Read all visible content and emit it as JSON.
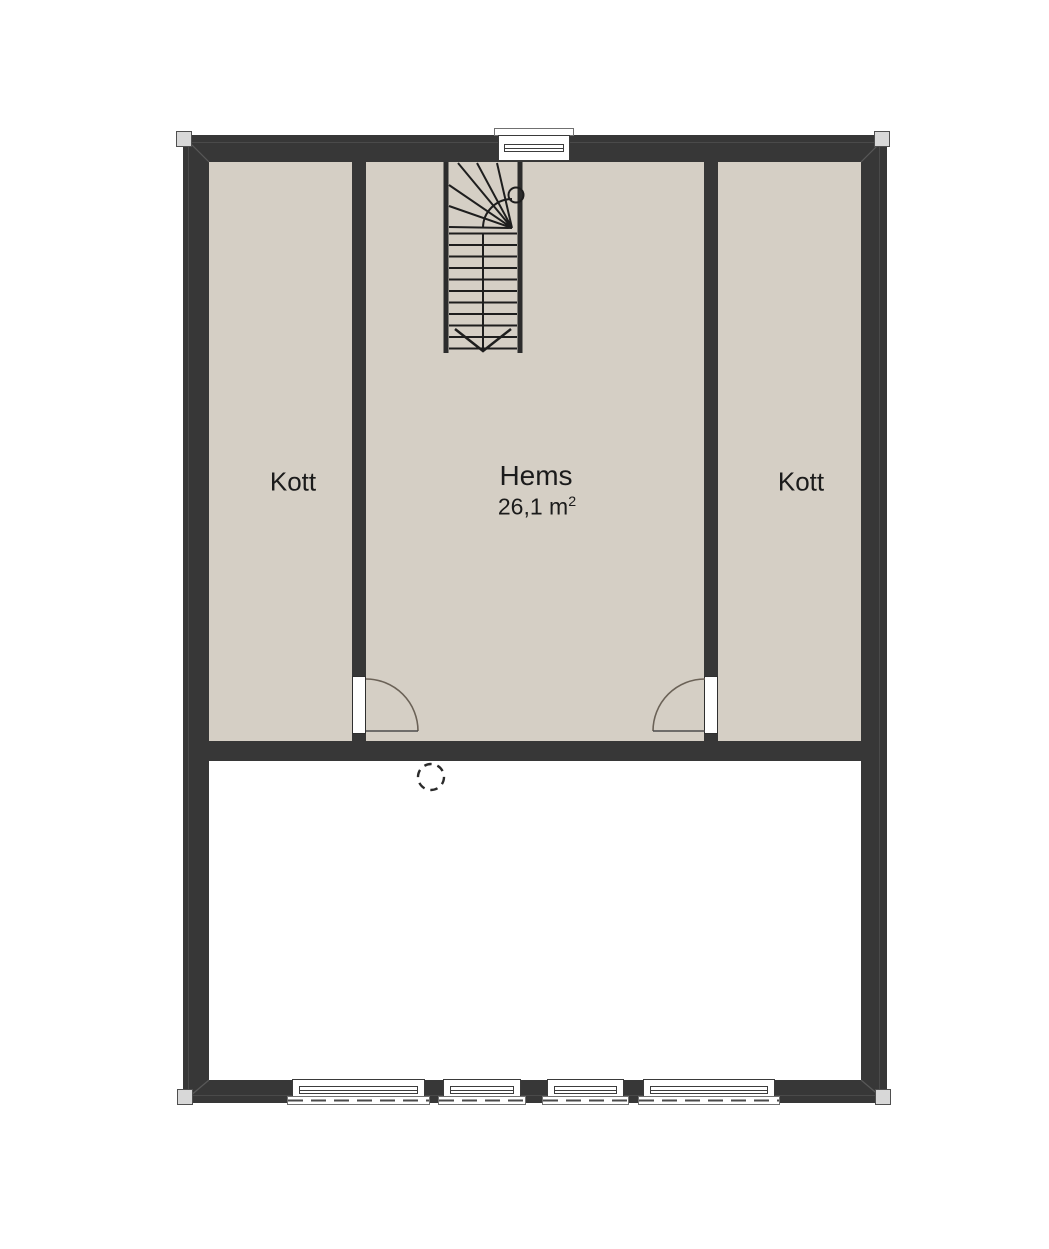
{
  "plan": {
    "rooms": [
      {
        "name": "Kott",
        "position": "left"
      },
      {
        "name": "Hems",
        "position": "center",
        "area_value": "26,1 m",
        "area_superscript": "2"
      },
      {
        "name": "Kott",
        "position": "right"
      }
    ],
    "symbols": {
      "staircase": "u-winder-staircase",
      "stair_direction_arrow": "chevron-down",
      "door_left": "quarter-swing-right",
      "door_right": "quarter-swing-left",
      "chimney": "dashed-circle",
      "window_count_top": 1,
      "window_count_bottom": 4,
      "corner_markers": 4
    },
    "colors": {
      "wall": "#373737",
      "attic_floor": "#d5cfc5",
      "void_floor": "#ffffff",
      "stair_line": "#1e1e1e",
      "door_arc": "#6b6257",
      "text": "#1b1b1b"
    }
  }
}
